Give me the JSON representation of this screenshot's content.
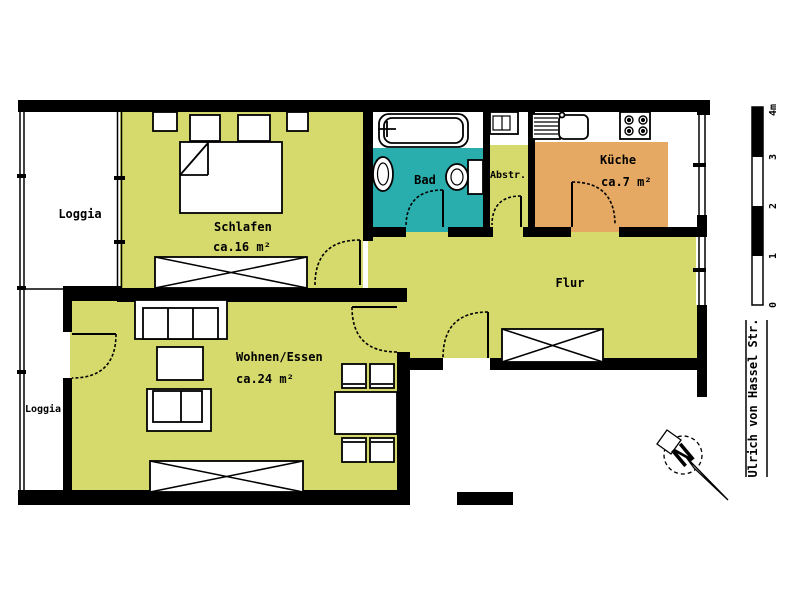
{
  "plan_labels": {
    "loggia_top": "Loggia",
    "loggia_bottom": "Loggia",
    "schlafen": "Schlafen",
    "schlafen_area": "ca.16 m²",
    "wohnen": "Wohnen/Essen",
    "wohnen_area": "ca.24 m²",
    "bad": "Bad",
    "abstell": "Abstr.",
    "kueche": "Küche",
    "kueche_area": "ca.7 m²",
    "flur": "Flur"
  },
  "scale_bar": {
    "labels": [
      "4m",
      "3",
      "2",
      "1",
      "0"
    ]
  },
  "street": {
    "name": "Ulrich von Hassel Str."
  },
  "compass": {
    "north_label": "N"
  },
  "colors": {
    "room_green": "#d6da6c",
    "bath_teal": "#2aadad",
    "kitchen_orange": "#e5a963",
    "wall_black": "#000000",
    "background": "#ffffff"
  }
}
